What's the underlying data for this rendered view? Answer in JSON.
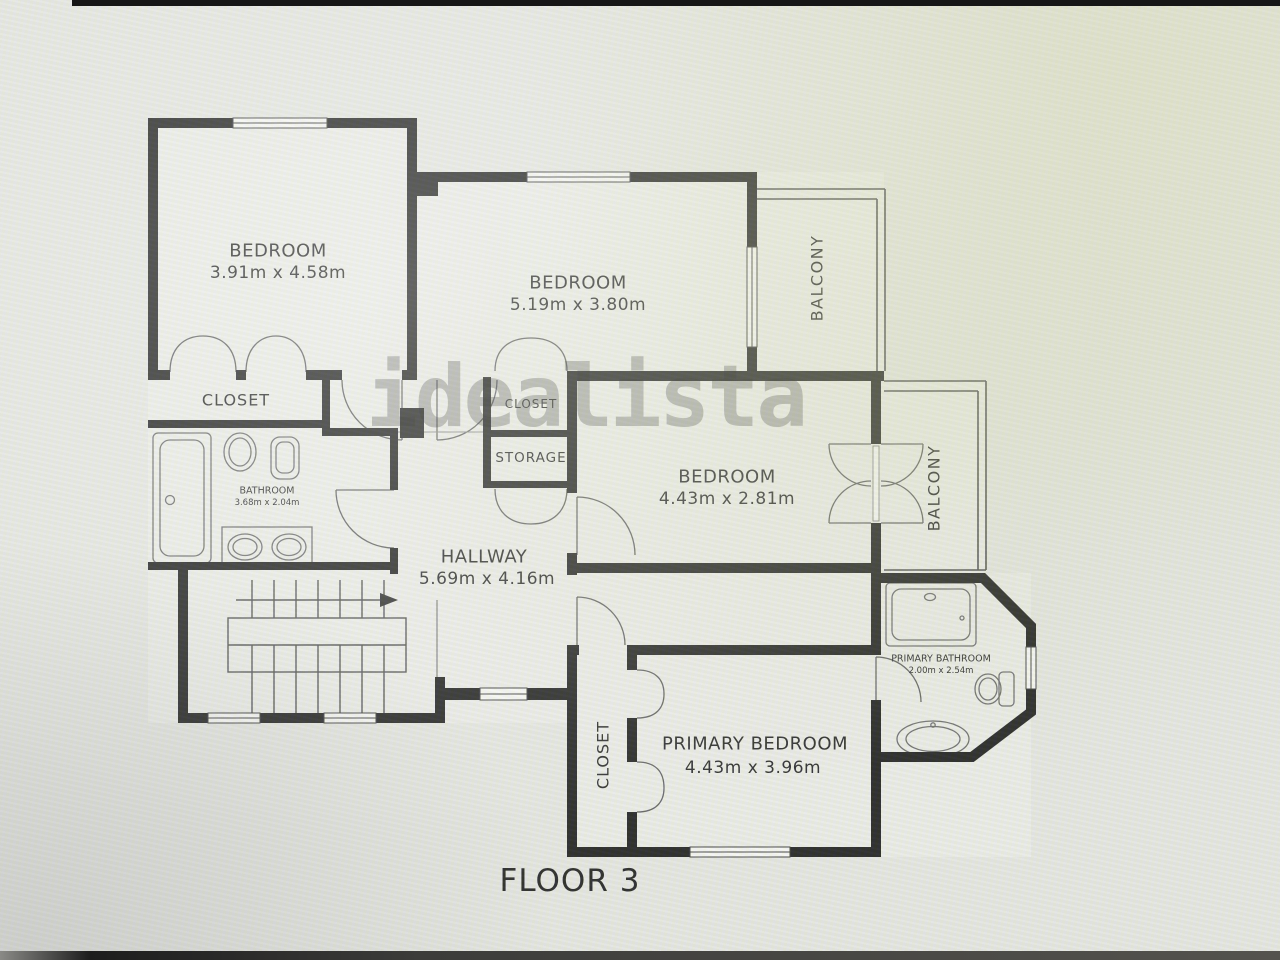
{
  "floor_plan": {
    "title": "FLOOR 3",
    "watermark": "idealista",
    "rooms": {
      "bedroom_1": {
        "label": "BEDROOM",
        "dims": "3.91m x 4.58m"
      },
      "bedroom_2": {
        "label": "BEDROOM",
        "dims": "5.19m x 3.80m"
      },
      "bedroom_3": {
        "label": "BEDROOM",
        "dims": "4.43m x 2.81m"
      },
      "primary_bedroom": {
        "label": "PRIMARY BEDROOM",
        "dims": "4.43m x 3.96m"
      },
      "hallway": {
        "label": "HALLWAY",
        "dims": "5.69m x 4.16m"
      },
      "bathroom": {
        "label": "BATHROOM",
        "dims": "3.68m x 2.04m"
      },
      "primary_bathroom": {
        "label": "PRIMARY BATHROOM",
        "dims": "2.00m x 2.54m"
      },
      "closet_bedroom_1": {
        "label": "CLOSET"
      },
      "closet_hall": {
        "label": "CLOSET"
      },
      "storage": {
        "label": "STORAGE"
      },
      "closet_primary": {
        "label": "CLOSET"
      },
      "balcony_top": {
        "label": "BALCONY"
      },
      "balcony_right": {
        "label": "BALCONY"
      }
    },
    "colors": {
      "wall": "#1b1b1b",
      "thin_line": "#4a4a4a",
      "fixture_line": "#6a6a6a",
      "label_text": "#242424",
      "watermark_gray": "#767676",
      "background": "#e9eae5"
    }
  }
}
